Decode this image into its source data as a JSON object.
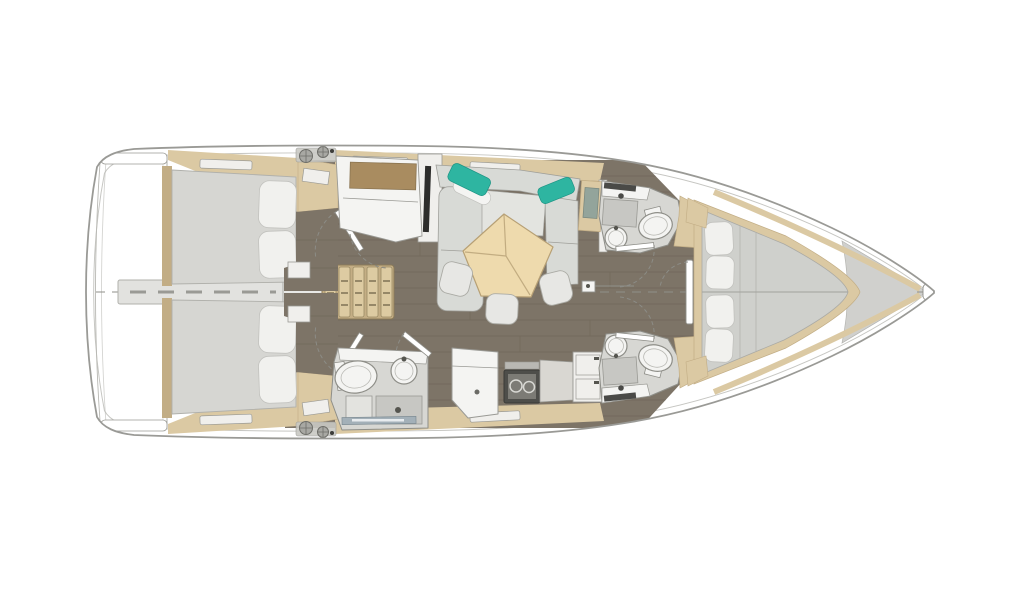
{
  "scene": {
    "type": "floor-plan",
    "subject": "sailing-yacht-interior-layout-top-view",
    "orientation": "bow-pointing-right",
    "areas": [
      "swim-platform",
      "aft-cabin-port",
      "aft-cabin-starboard",
      "companionway-steps",
      "nav-station",
      "saloon",
      "dining-table",
      "galley",
      "aft-head",
      "forward-head-port",
      "forward-head-starboard",
      "forward-cabin",
      "foredeck"
    ]
  },
  "colors": {
    "page_bg": "#ffffff",
    "hull_fill": "#ffffff",
    "hull_stroke": "#9a9a96",
    "floor": "#7d7467",
    "floor_line": "#675e50",
    "wood": "#dbc9a3",
    "wood_dark": "#c2ad85",
    "desk_wood": "#a98c60",
    "mattress": "#d6d6d2",
    "bed_gray": "#cfd0cc",
    "pillow": "#f1f1ee",
    "pillow_stroke": "#c2c2be",
    "sofa": "#d8dad6",
    "sofa_seat": "#e3e4e0",
    "teal": "#2eb5a1",
    "table_wood": "#eedaad",
    "table_edge": "#b7a075",
    "stool": "#e7e7e4",
    "head_floor": "#d7d7d3",
    "fixture": "#f4f4f2",
    "shower_pan": "#c7c7c3",
    "steel_bar": "#a3b0b8",
    "stove_body": "#4e4e4a",
    "stove_panel": "#7c7b75",
    "cabinet_white": "#f0efec",
    "counter_gray": "#d9d7d2",
    "partition": "#e2e2df",
    "landing": "#e9e9e6",
    "step_base": "#c4ae85",
    "step_tread": "#ddcba2",
    "foredeck": "#d0d0cd",
    "tv_black": "#2d2d2b",
    "window_glass": "#93a49b",
    "winch": "#a8a8a3"
  }
}
